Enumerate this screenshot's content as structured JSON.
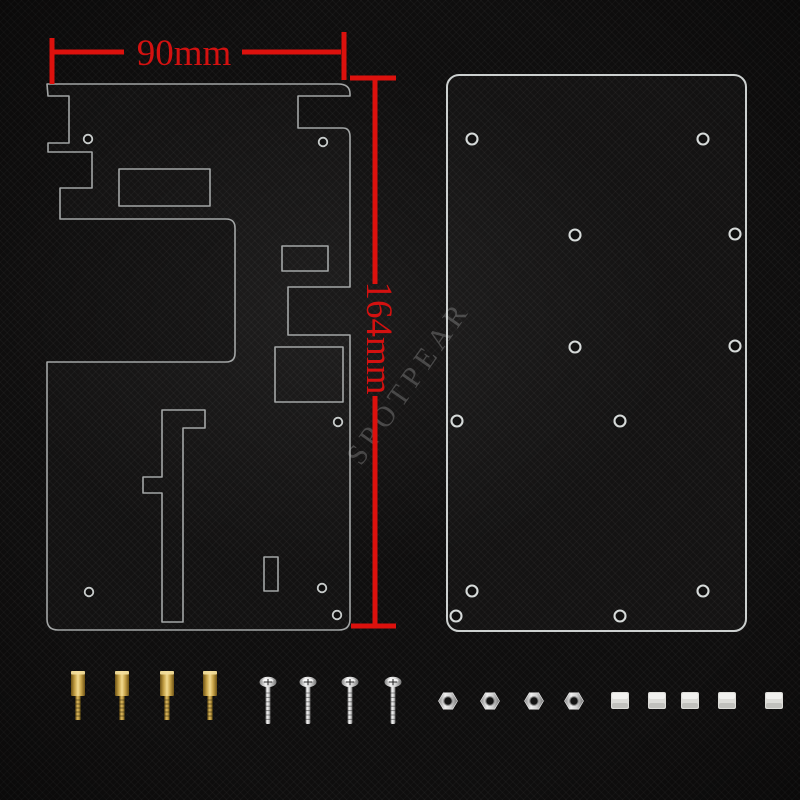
{
  "scene": {
    "description": "acrylic case plates kit product photo",
    "background_color": "#0f0e0e"
  },
  "watermark": {
    "text": "SPOTPEAR"
  },
  "dimensions": {
    "width_label": "90mm",
    "height_label": "164mm"
  },
  "colors": {
    "dimension_red": "#dc110d",
    "dimension_text_red": "#d31110",
    "plate_stroke": "#c4c8c7",
    "brass": "#c9a54a",
    "silver": "#d6d6d6",
    "spacer_white": "#dcdcd8"
  },
  "left_plate": {
    "outline": "M47,84 H338 Q350,84 350,94 V96 H298 V128 H343 Q350,128 350,137 V287 H288 V335 H350 V619 Q350,630 339,630 H58 Q47,630 47,619 V362 H226 Q235,362 235,353 V228 Q235,219 226,219 H60 V188 H92 V152 H48 V143 H69 V96 H48 Z",
    "cutouts": [
      "M119,169 H210 V206 H119 Z",
      "M282,246 H328 V271 H282 Z",
      "M275,347 H343 V402 H275 Z",
      "M162,410 H205 V428 H183 V622 H162 V493 H143 V477 H162 Z",
      "M264,557 H278 V591 H264 Z"
    ],
    "holes": [
      [
        88,
        139
      ],
      [
        323,
        142
      ],
      [
        338,
        422
      ],
      [
        89,
        592
      ],
      [
        322,
        588
      ],
      [
        337,
        615
      ]
    ],
    "hole_radius": 4.3
  },
  "right_plate": {
    "x": 447,
    "y": 75,
    "width": 299,
    "height": 556,
    "corner_radius": 12,
    "holes": [
      [
        472,
        139
      ],
      [
        703,
        139
      ],
      [
        575,
        235
      ],
      [
        735,
        234
      ],
      [
        575,
        347
      ],
      [
        735,
        346
      ],
      [
        457,
        421
      ],
      [
        620,
        421
      ],
      [
        472,
        591
      ],
      [
        703,
        591
      ],
      [
        456,
        616
      ],
      [
        620,
        616
      ]
    ],
    "hole_radius": 5.5
  },
  "dimension_lines": {
    "stroke_width": 5,
    "segments": [
      "M53,52 H124",
      "M242,52 H341",
      "M52,38 V84",
      "M344,32 V80",
      "M350,78 H396",
      "M375,80 V284",
      "M375,396 V626",
      "M351,626 H396"
    ]
  },
  "hardware": {
    "standoffs": {
      "count": 4,
      "x": [
        78,
        122,
        167,
        210
      ]
    },
    "screws": {
      "count": 4,
      "x": [
        268,
        308,
        350,
        393
      ]
    },
    "nuts": {
      "count": 4,
      "x": [
        448,
        490,
        534,
        574
      ]
    },
    "spacers": {
      "count": 5,
      "x": [
        620,
        657,
        690,
        727,
        774
      ]
    }
  }
}
